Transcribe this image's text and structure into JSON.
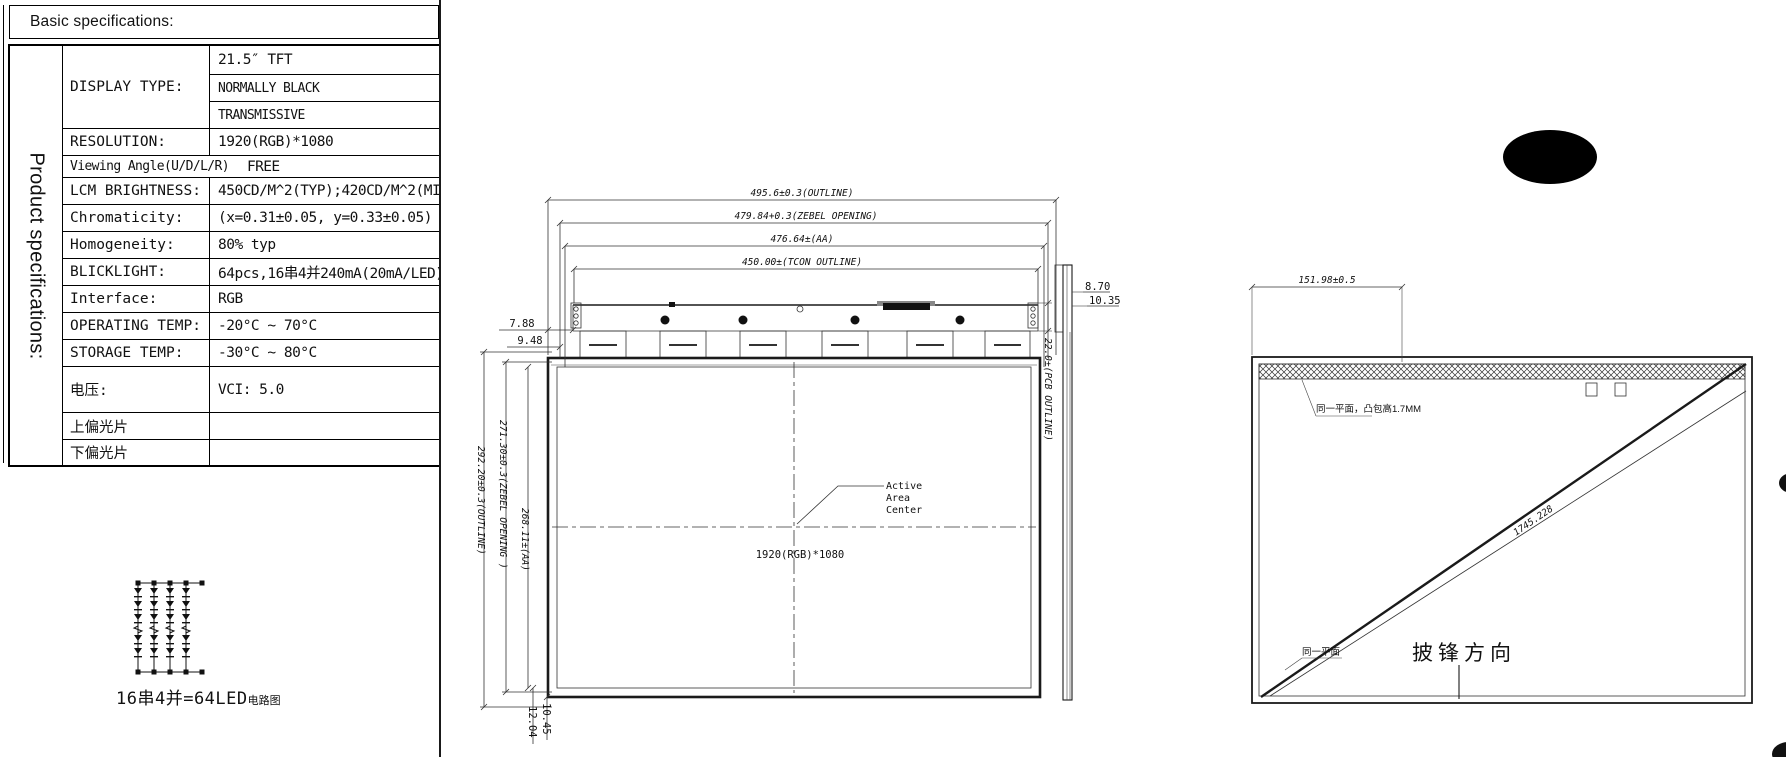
{
  "colors": {
    "ink": "#1a1a1a",
    "background": "#ffffff"
  },
  "header": {
    "title": "Basic specifications:"
  },
  "side_label": "Product specifications:",
  "spec_table": {
    "display_type": {
      "label": "DISPLAY TYPE:",
      "values": [
        "21.5″ TFT",
        "NORMALLY BLACK",
        "TRANSMISSIVE"
      ]
    },
    "rows": [
      {
        "label": "RESOLUTION:",
        "value": "1920(RGB)*1080"
      },
      {
        "label": "Viewing Angle(U/D/L/R)",
        "value": "FREE"
      },
      {
        "label": "LCM BRIGHTNESS:",
        "value": "450CD/M^2(TYP);420CD/M^2(MIN)"
      },
      {
        "label": "Chromaticity:",
        "value": "(x=0.31±0.05, y=0.33±0.05)"
      },
      {
        "label": "Homogeneity:",
        "value": "80% typ"
      },
      {
        "label": "BLICKLIGHT:",
        "value": "64pcs,16串4并240mA(20mA/LED)"
      },
      {
        "label": "Interface:",
        "value": "RGB"
      },
      {
        "label": "OPERATING TEMP:",
        "value": "-20°C ~ 70°C"
      },
      {
        "label": "STORAGE TEMP:",
        "value": "-30°C ~ 80°C"
      },
      {
        "label": "电压:",
        "value": "VCI: 5.0"
      },
      {
        "label": "上偏光片",
        "value": ""
      },
      {
        "label": "下偏光片",
        "value": ""
      }
    ]
  },
  "led_diagram": {
    "caption_main": "16串4并=64LED",
    "caption_small": "电路图"
  },
  "front_view": {
    "dim_outline_w": "495.6±0.3(OUTLINE)",
    "dim_bezel_w": "479.84+0.3(ZEBEL OPENING)",
    "dim_aa_w": "476.64±(AA)",
    "dim_tcon_w": "450.00±(TCON OUTLINE)",
    "dim_outline_h": "292.20±0.3(OUTLINE)",
    "dim_bezel_h": "271.30±0.3(ZEBEL OPENING )",
    "dim_aa_h": "268.11±(AA)",
    "dim_top_left_1": "7.88",
    "dim_top_left_2": "9.48",
    "dim_bottom_1": "12.04",
    "dim_bottom_2": "10.45",
    "dim_pcb_h": "22.0±(PCB OUTLINE)",
    "center_label_lines": [
      "Active",
      "Area",
      "Center"
    ],
    "resolution": "1920(RGB)*1080"
  },
  "side_view": {
    "dim_1": "8.70",
    "dim_2": "10.35"
  },
  "rear_view": {
    "dim_top": "151.98±0.5",
    "note_flat_top": "同一平面，凸包高1.7MM",
    "note_flat_bottom": "同一平面",
    "diagonal_label": "1745.228",
    "burr_direction": "披锋方向"
  }
}
